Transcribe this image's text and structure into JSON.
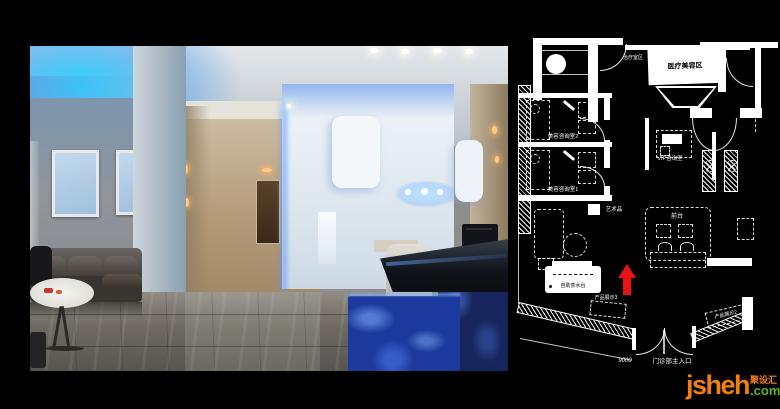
{
  "plan": {
    "labels": {
      "treatment_zone": "治疗室区",
      "medical_beauty_room": "医疗美容区",
      "consult_room_2": "美容咨询室2",
      "consult_room_1": "美容咨询室1",
      "vip_room": "VIP咨询室",
      "artwork": "艺术品",
      "front_desk": "前台",
      "tea_station": "自助茶水台",
      "product_display_3": "产品展示3",
      "product_display_2": "产品展示2",
      "entrance_dimension": "9000",
      "main_entrance": "门诊部主入口"
    },
    "north_arrow_color": "#e81414",
    "line_color": "#ffffff",
    "background": "#000000"
  },
  "photo": {
    "accent_colors": {
      "ceiling_glow": "#35c8ff",
      "desk_marble": "#1c3a9e",
      "wall_glow": "#8fb6ee"
    }
  },
  "watermark": {
    "brand": "jsheh",
    "domain_suffix": ".com",
    "brand_cn": "聚设汇",
    "brand_color": "#f07f13",
    "suffix_color": "#5fae28"
  }
}
